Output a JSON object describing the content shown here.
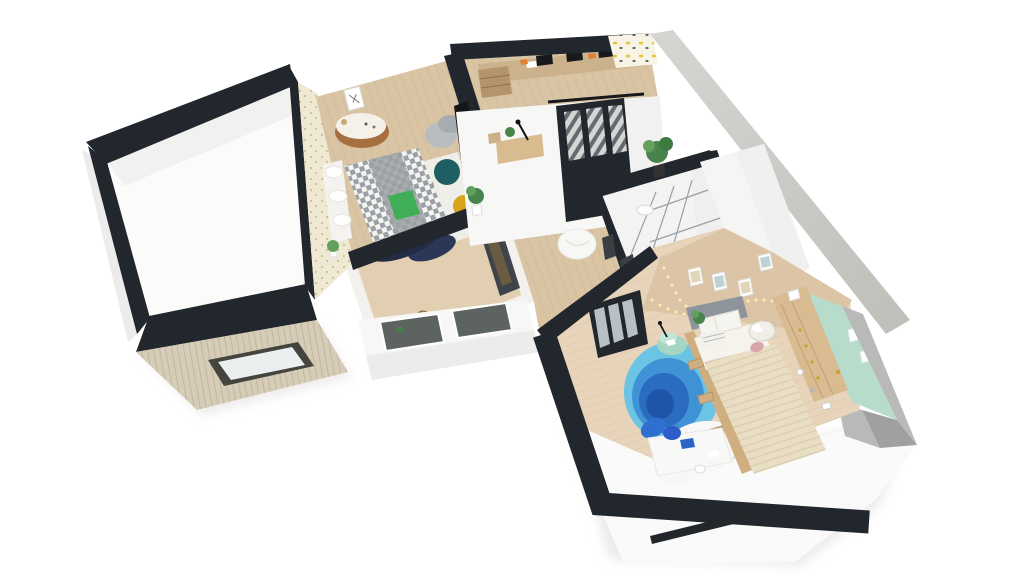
{
  "scene": {
    "title": "3D apartment floor plan render",
    "style": "isometric cutaway, furnished, white background"
  },
  "palette": {
    "pageBg": "#ffffff",
    "wallDark": "#22262d",
    "floorWhite": "#fbfbfa",
    "faceWhite": "#f7f7f6",
    "faceShadow": "#ececec",
    "faceGray": "#b9bab8",
    "faceGrayDark": "#9fa19f",
    "concrete1": "#d6d5d2",
    "concrete2": "#bfbfba",
    "woodFloor": "#d9c4a4",
    "woodFloorLight": "#e2cfb2",
    "bedroom2Floor": "#e7d4ba",
    "beigeWall": "#dcc5a6",
    "mintWall": "#b7dccc",
    "roofSlat": "#d6ccb8",
    "roofSlatLine": "#b9ae97",
    "skylightFrame": "#45453f",
    "skylightGlass": "#eceff0",
    "wallpaperCream": "#efe8d2",
    "wallpaperDot": "#c3b98a",
    "wallpaperYellowBg": "#f7f4e6",
    "wallpaperYellowDot": "#e3c63a",
    "glassPane": "#5d635e",
    "glassLight": "#c8d2d4",
    "dresserWood": "#a76f3f",
    "deskWood": "#ccb28c",
    "armchairGray": "#b9bdc0",
    "bedWhite": "#f4f3ef",
    "checkDark": "#9aa0a4",
    "bedNavy": "#232c45",
    "bedGreen": "#3fae57",
    "rugWhite": "#efeee8",
    "rugNavy": "#2c3757",
    "rugMustard": "#d9a41d",
    "rugGray": "#9aa0a4",
    "rugTeal": "#1f5f63",
    "stoolWood": "#b98d5a",
    "cabinetDark": "#3f444a",
    "plantGreen": "#47834a",
    "plantGreenLight": "#62a05c",
    "beanbag": "#f7f7f5",
    "blue1": "#6cc4e4",
    "blue2": "#3f93d4",
    "blue3": "#2a6cc0",
    "blue4": "#1f55a8",
    "fluffWhite": "#f7f7f5",
    "duvetBlue": "#2f6fd0",
    "mintTable1": "#a5d6c4",
    "mintTable2": "#c2e6d8",
    "headboardGray": "#8d949b",
    "pillowWhite": "#f6f4ef",
    "blanketCream": "#e9dec4",
    "knitLine": "#d9cdb0",
    "frameWood": "#cfae80",
    "wardrobeWood": "#d8bb90",
    "goldDot": "#c9a227",
    "basketWhite": "#f0eee6",
    "pinkCloth": "#d8a8a8",
    "deskWhite": "#f8f8f7",
    "chairBlue": "#2d5cc8",
    "folderBlue": "#2a64c4",
    "windowSlit": "#23262b",
    "stringLight": "#ffedb0",
    "monitorDark": "#17191c",
    "orangeItem": "#e08030"
  },
  "rooms": [
    {
      "id": "left-room",
      "label": "Empty room"
    },
    {
      "id": "roof",
      "label": "Roof with skylight"
    },
    {
      "id": "bedroom-1",
      "label": "Bedroom 1",
      "furniture": [
        "double bed",
        "geometric rug",
        "round dresser",
        "armchair",
        "wall art",
        "plant"
      ]
    },
    {
      "id": "office",
      "label": "Office",
      "furniture": [
        "double desk",
        "monitors",
        "striped rug",
        "wall desk",
        "sliding glass door"
      ]
    },
    {
      "id": "dining",
      "label": "Kitchen dining",
      "furniture": [
        "bar stools",
        "dark cabinets",
        "glazed wall"
      ]
    },
    {
      "id": "hallway",
      "label": "Hallway",
      "furniture": [
        "beanbag",
        "potted plants"
      ]
    },
    {
      "id": "bathroom",
      "label": "Bathroom",
      "furniture": [
        "glass shower screen",
        "ceiling light"
      ]
    },
    {
      "id": "bedroom-2",
      "label": "Bedroom 2",
      "furniture": [
        "bed with knit blanket",
        "blue round rug",
        "mint side table",
        "wardrobe",
        "white desk",
        "laundry basket",
        "string lights",
        "framed pictures",
        "glass door"
      ]
    }
  ]
}
